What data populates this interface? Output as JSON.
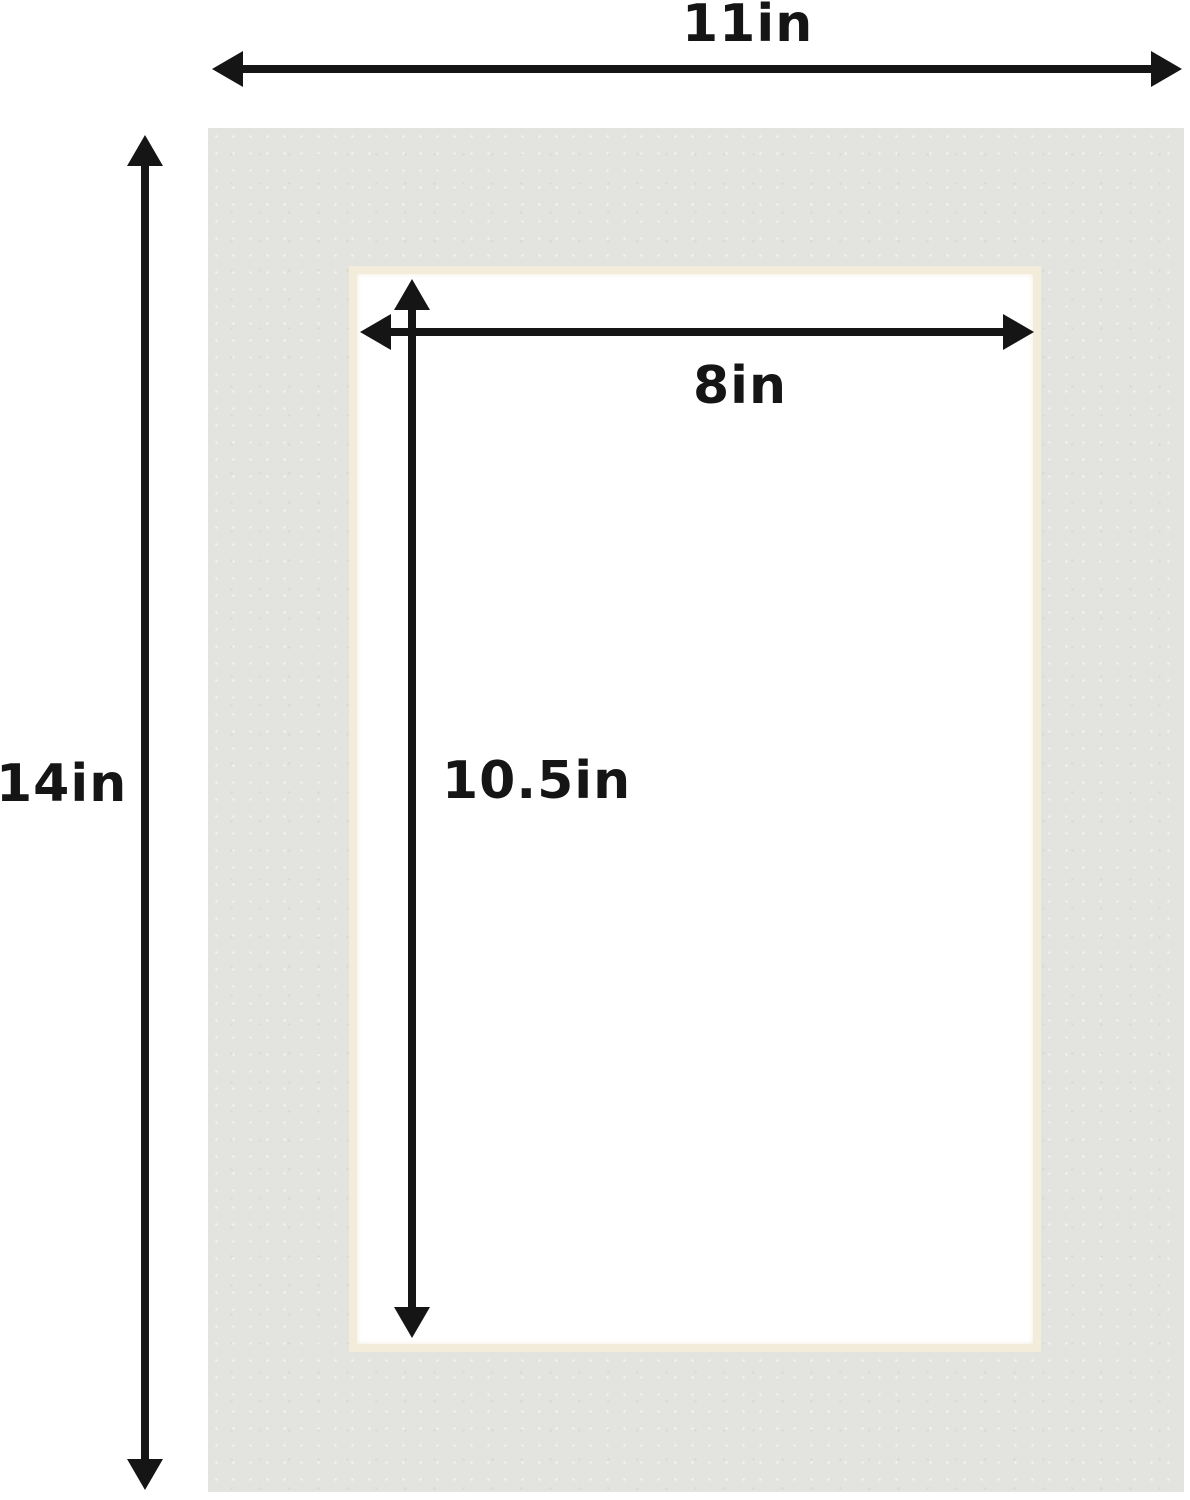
{
  "diagram": {
    "labels": {
      "outer_width": "11in",
      "outer_height": "14in",
      "opening_width": "8in",
      "opening_height": "10.5in"
    },
    "colors": {
      "background": "#ffffff",
      "mat_board": "#e3e4df",
      "opening_bevel": "#f4ecdb",
      "opening_fill": "#ffffff",
      "dimension_ink": "#151515"
    }
  }
}
